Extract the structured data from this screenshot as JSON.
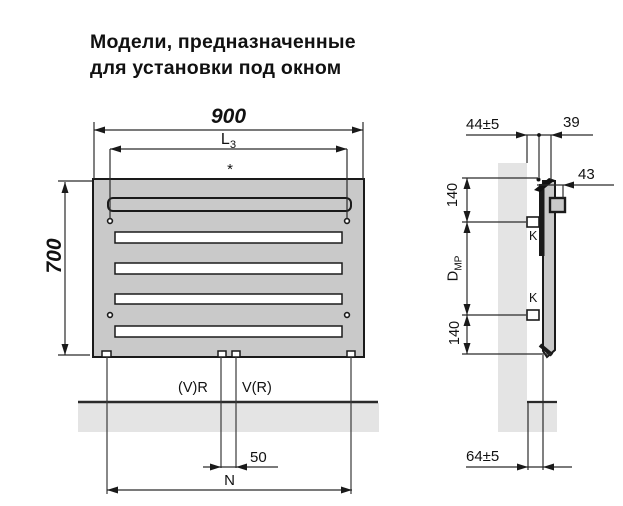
{
  "title": {
    "line1": "Модели, предназначенные",
    "line2": "для установки под окном"
  },
  "front_view": {
    "width_dim": "900",
    "height_dim": "700",
    "l3_main": "L",
    "l3_sub": "3",
    "asterisk": "*",
    "valve_left_label": "(V)R",
    "valve_right_label": "V(R)",
    "pipe_spacing_dim": "50",
    "pipe_distance_dim": "N"
  },
  "side_view": {
    "wall_clearance_dim": "44±5",
    "depth_dim": "39",
    "bracket_depth_dim": "43",
    "top_offset_dim": "140",
    "bottom_offset_dim": "140",
    "dmp_main": "D",
    "dmp_sub": "МР",
    "k_top_label": "K",
    "k_bottom_label": "K",
    "floor_clearance_dim": "64±5"
  },
  "colors": {
    "radiator_fill": "#c9c9c9",
    "wall_fill": "#e4e4e4",
    "line_color": "#1a1a1a"
  }
}
